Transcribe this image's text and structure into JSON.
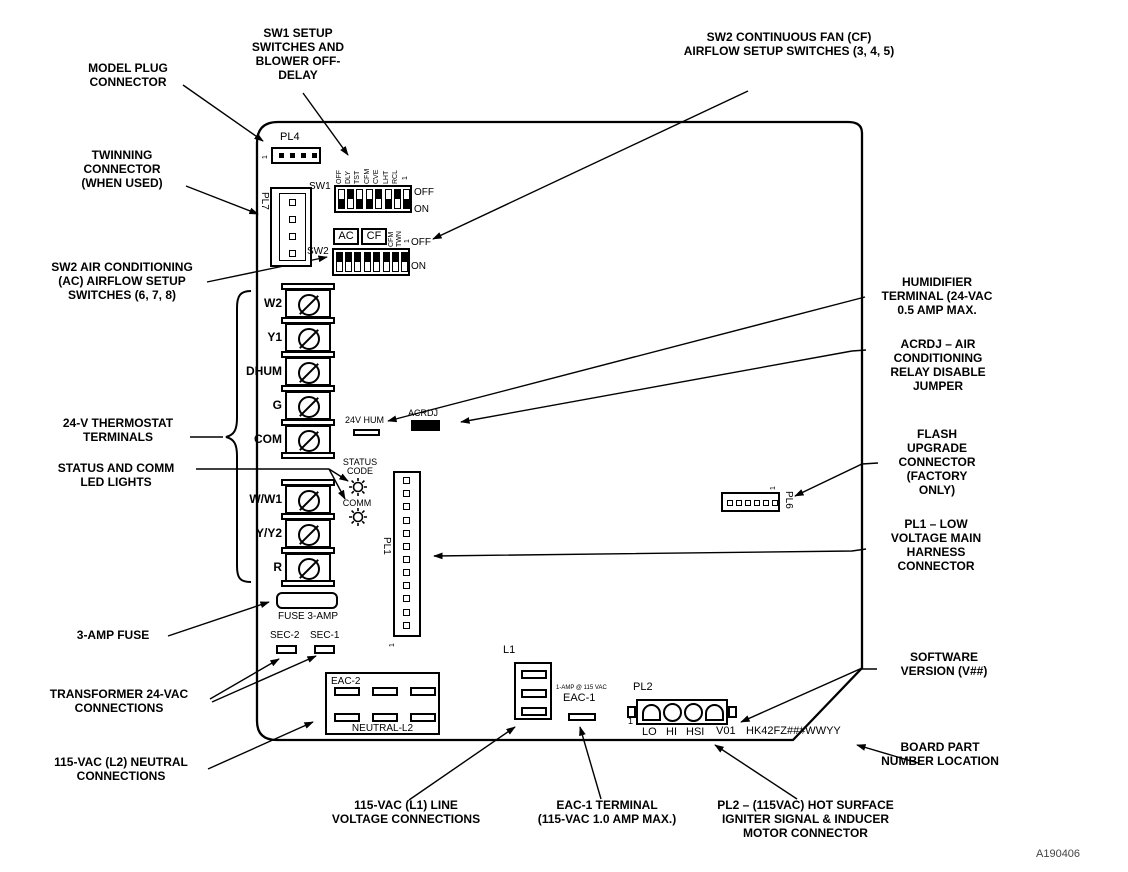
{
  "figure": {
    "id": "A190406"
  },
  "callouts": {
    "model_plug": "MODEL PLUG\nCONNECTOR",
    "sw1_setup": "SW1 SETUP\nSWITCHES AND\nBLOWER OFF-\nDELAY",
    "sw2_cf": "SW2 CONTINUOUS FAN (CF)\nAIRFLOW SETUP SWITCHES (3, 4, 5)",
    "twinning": "TWINNING\nCONNECTOR\n(WHEN USED)",
    "sw2_ac": "SW2 AIR CONDITIONING\n(AC) AIRFLOW SETUP\nSWITCHES (6, 7, 8)",
    "thermostat": "24-V THERMOSTAT\nTERMINALS",
    "status_comm": "STATUS AND COMM\nLED LIGHTS",
    "fuse": "3-AMP FUSE",
    "transformer": "TRANSFORMER 24-VAC\nCONNECTIONS",
    "l2_neutral": "115-VAC (L2) NEUTRAL\nCONNECTIONS",
    "l1_line": "115-VAC (L1) LINE\nVOLTAGE CONNECTIONS",
    "eac1_terminal": "EAC-1 TERMINAL\n(115-VAC 1.0 AMP MAX.)",
    "pl2_connector": "PL2 – (115VAC) HOT SURFACE\nIGNITER SIGNAL & INDUCER\nMOTOR CONNECTOR",
    "humidifier": "HUMIDIFIER\nTERMINAL (24-VAC\n0.5 AMP MAX.",
    "acrdj": "ACRDJ – AIR\nCONDITIONING\nRELAY DISABLE\nJUMPER",
    "flash": "FLASH\nUPGRADE\nCONNECTOR\n(FACTORY\nONLY)",
    "pl1": "PL1 – LOW\nVOLTAGE MAIN\nHARNESS\nCONNECTOR",
    "software": "SOFTWARE\nVERSION (V##)",
    "board_part": "BOARD PART\nNUMBER LOCATION"
  },
  "board": {
    "pl4": {
      "label": "PL4",
      "pin1": "1"
    },
    "pl7": {
      "label": "PL7",
      "pin1": "1"
    },
    "sw1": {
      "label": "SW1",
      "off": "OFF",
      "on": "ON",
      "pin_labels": [
        "OFF",
        "DLY",
        "TST",
        "CFM",
        "CVE",
        "LHT",
        "RCL",
        "1"
      ],
      "toggles": [
        "down",
        "up",
        "down",
        "down",
        "up",
        "down",
        "up",
        "down"
      ]
    },
    "sw2": {
      "label": "SW2",
      "ac": "AC",
      "cf": "CF",
      "off": "OFF",
      "on": "ON",
      "pin_labels": [
        "CFM",
        "TWN",
        "1"
      ],
      "toggles": [
        "up",
        "up",
        "up",
        "up",
        "up",
        "up",
        "up",
        "up"
      ]
    },
    "thermostat_terminals": [
      "W2",
      "Y1",
      "DHUM",
      "G",
      "COM"
    ],
    "lower_terminals": [
      "W/W1",
      "Y/Y2",
      "R"
    ],
    "hum_terminal": "24V HUM",
    "acrdj": "ACRDJ",
    "status_led": "STATUS\nCODE",
    "comm_led": "COMM",
    "pl1": {
      "label": "PL1",
      "pin1": "1"
    },
    "pl6": {
      "label": "PL6",
      "pin1": "1"
    },
    "fuse": "FUSE 3-AMP",
    "sec2": "SEC-2",
    "sec1": "SEC-1",
    "eac2": "EAC-2",
    "neutral_l2": "NEUTRAL-L2",
    "l1": "L1",
    "eac1": {
      "rating": "1-AMP @ 115 VAC",
      "label": "EAC-1"
    },
    "pl2": {
      "label": "PL2",
      "pin1": "1",
      "pins": [
        "LO",
        "HI",
        "HSI"
      ]
    },
    "software_version": "V01",
    "part_number": "HK42FZ###WWYY"
  }
}
